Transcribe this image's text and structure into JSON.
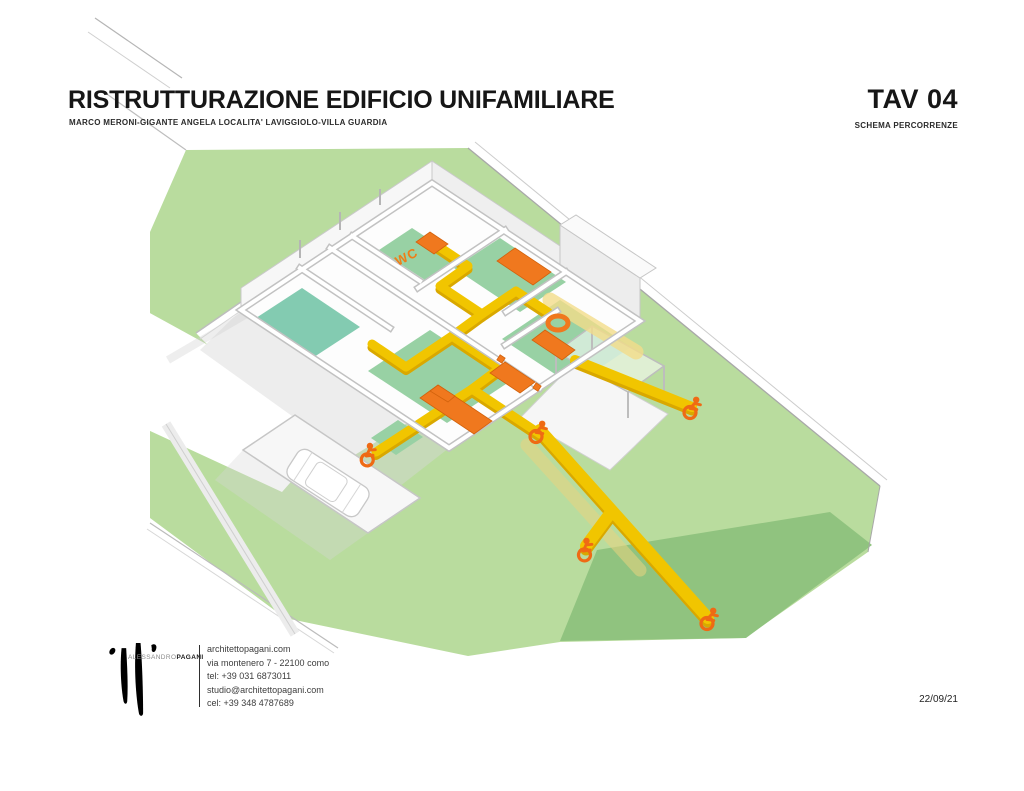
{
  "header": {
    "title": "RISTRUTTURAZIONE EDIFICIO UNIFAMILIARE",
    "subtitle": "MARCO MERONI-GIGANTE ANGELA LOCALITA' LAVIGGIOLO-VILLA GUARDIA",
    "sheet_number": "TAV 04",
    "sheet_name": "SCHEMA PERCORRENZE"
  },
  "drawing": {
    "wc_label": "WC",
    "wheelchair_icon_locations": [
      "carport-entrance",
      "south-garden-exit",
      "east-terrace",
      "garden-branch",
      "garden-path-end"
    ],
    "colors": {
      "lawn": "#b9dc9e",
      "slope": "#90c37f",
      "floor_green": "#98d1a4",
      "floor_teal": "#83cbb1",
      "path_yellow": "#f1c500",
      "path_yellow_dark": "#d9a800",
      "path_yellow_pale": "#f3dc8a",
      "accent_orange": "#ef7518",
      "wall_gray": "#c6c6c6"
    }
  },
  "footer": {
    "logo_name_regular": "ALESSANDRO",
    "logo_name_bold": "PAGANI",
    "contact_lines": [
      "architettopagani.com",
      "via montenero 7 - 22100 como",
      "tel: +39 031 6873011",
      "studio@architettopagani.com",
      "cel: +39 348 4787689"
    ],
    "date": "22/09/21"
  }
}
